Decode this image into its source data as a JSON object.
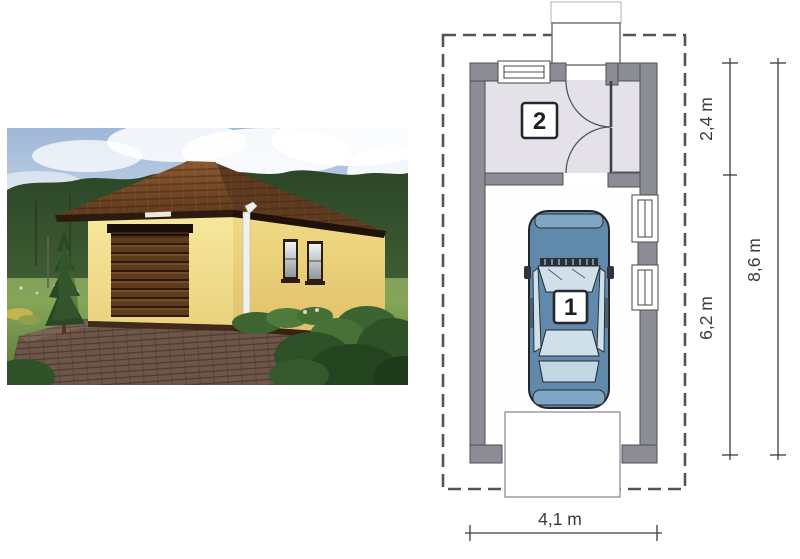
{
  "plan": {
    "rooms": [
      {
        "number": "1"
      },
      {
        "number": "2"
      }
    ],
    "dimensions": {
      "room2_depth": "2,4 m",
      "garage_depth": "6,2 m",
      "total_depth": "8,6 m",
      "width": "4,1 m"
    }
  },
  "colors": {
    "wall_gray": "#8C8C94",
    "wall_outline": "#4E4E56",
    "floor_lavender": "#E4E1E9",
    "dash_gray": "#53535B",
    "dim_text": "#3A3A40",
    "car_body": "#6089AB",
    "car_glass": "#CFE0EB",
    "roof_brown": "#74492A",
    "facade_yellow": "#F3E093",
    "door_brown": "#5E3B1D",
    "forest_green": "#2C4629",
    "lawn_green": "#7E9F50",
    "sky_blue": "#A9C0DA",
    "paving_brown": "#6E5649"
  }
}
